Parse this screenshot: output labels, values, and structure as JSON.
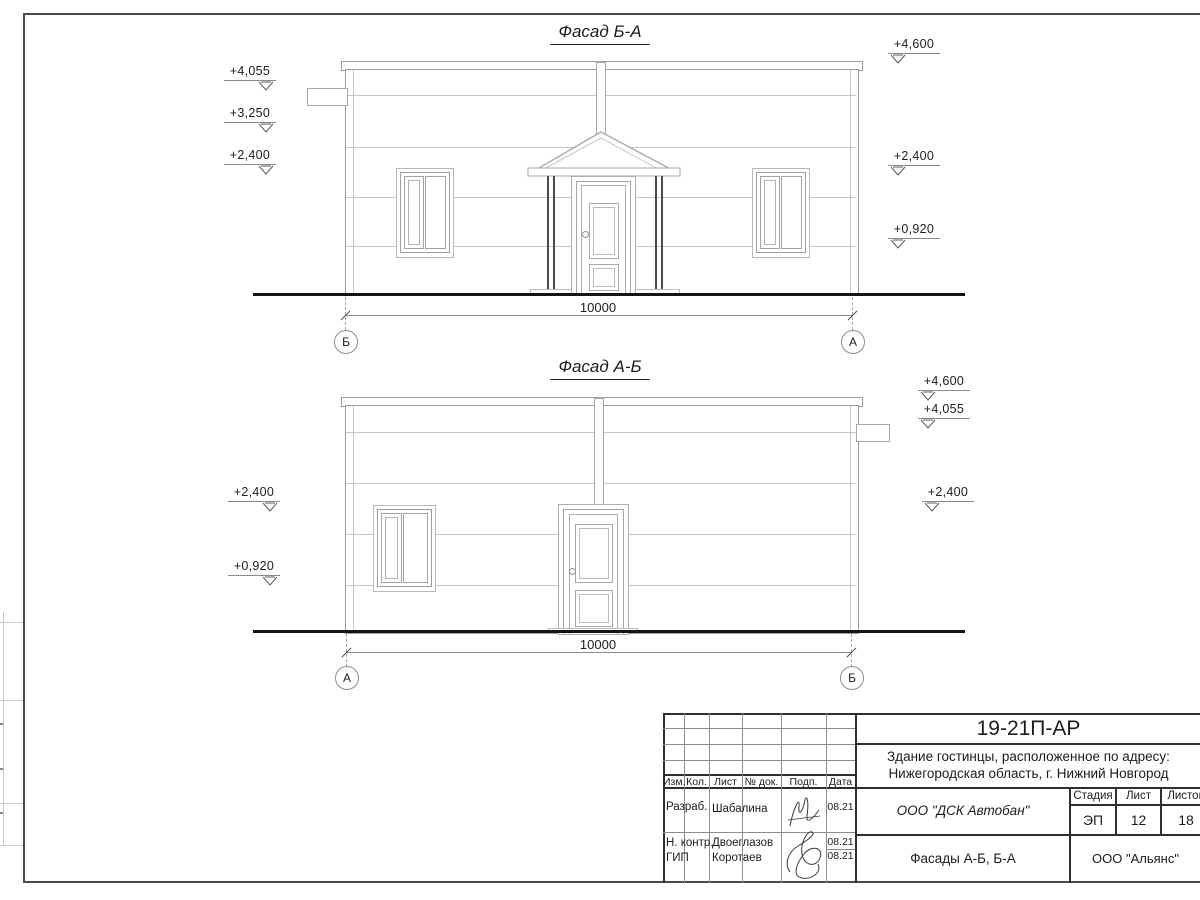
{
  "facades": {
    "f1": {
      "title": "Фасад Б-А",
      "dim": "10000",
      "axis_left": "Б",
      "axis_right": "А",
      "elev_left": [
        {
          "v": "+4,055"
        },
        {
          "v": "+3,250"
        },
        {
          "v": "+2,400"
        }
      ],
      "elev_right": [
        {
          "v": "+4,600"
        },
        {
          "v": "+2,400"
        },
        {
          "v": "+0,920"
        }
      ]
    },
    "f2": {
      "title": "Фасад А-Б",
      "dim": "10000",
      "axis_left": "А",
      "axis_right": "Б",
      "elev_left": [
        {
          "v": "+2,400"
        },
        {
          "v": "+0,920"
        }
      ],
      "elev_right": [
        {
          "v": "+4,600"
        },
        {
          "v": "+4,055"
        },
        {
          "v": "+2,400"
        }
      ]
    }
  },
  "title_block": {
    "doc_code": "19-21П-АР",
    "project_line1": "Здание гостинцы, расположенное по адресу:",
    "project_line2": "Нижегородская область, г. Нижний Новгород",
    "col_headers": {
      "izm": "Изм.",
      "kol": "Кол.",
      "list": "Лист",
      "doc": "№ док.",
      "podp": "Подп.",
      "data": "Дата"
    },
    "signers": [
      {
        "role": "Разраб.",
        "name": "Шабалина",
        "date": "08.21"
      },
      {
        "role": "Н. контр.",
        "name": "Двоеглазов",
        "date": "08.21"
      },
      {
        "role": "ГИП",
        "name": "Коротаев",
        "date": "08.21"
      }
    ],
    "contractor": "ООО \"ДСК Автобан\"",
    "stage_header": "Стадия",
    "sheet_header": "Лист",
    "sheets_header": "Листов",
    "stage": "ЭП",
    "sheet_no": "12",
    "sheets_total": "18",
    "drawing_title": "Фасады А-Б, Б-А",
    "org": "ООО \"Альянс\""
  },
  "colors": {
    "line_dark": "#2e2e2e",
    "line_medium": "#9c9c9c",
    "line_light": "#c6c6c6",
    "ground": "#141414"
  }
}
